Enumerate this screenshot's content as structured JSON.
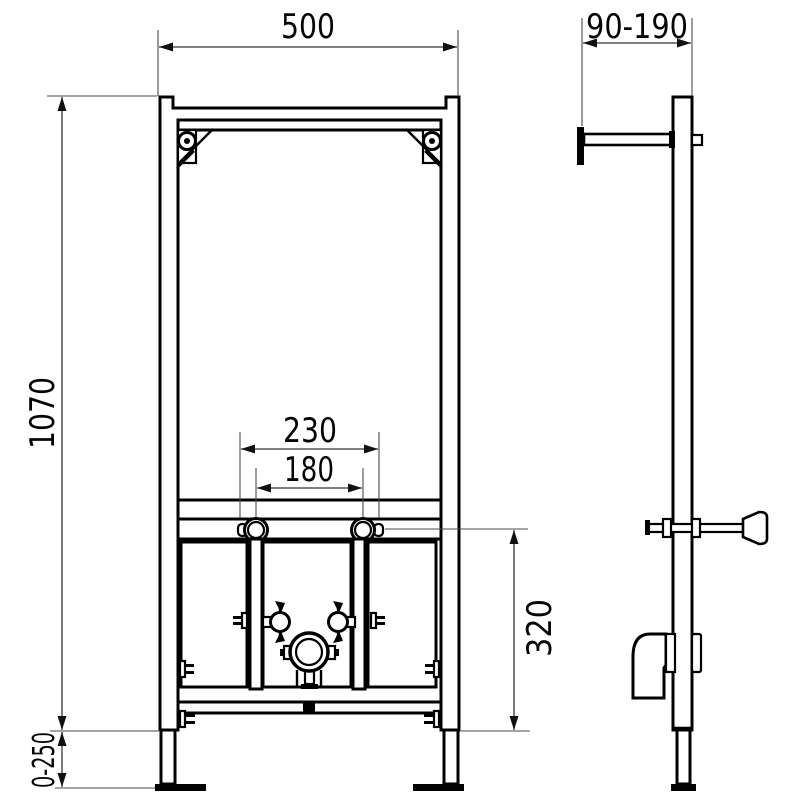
{
  "drawing": {
    "background": "#ffffff",
    "line_color": "#000000",
    "dimension_line_color": "#333333",
    "text_color": "#050505",
    "dimensions": {
      "frame_width": "500",
      "depth_range": "90-190",
      "frame_height": "1070",
      "fixing_spacing_outer": "230",
      "fixing_spacing_inner": "180",
      "outlet_height": "320",
      "leg_adjustment_range": "0-250"
    }
  }
}
